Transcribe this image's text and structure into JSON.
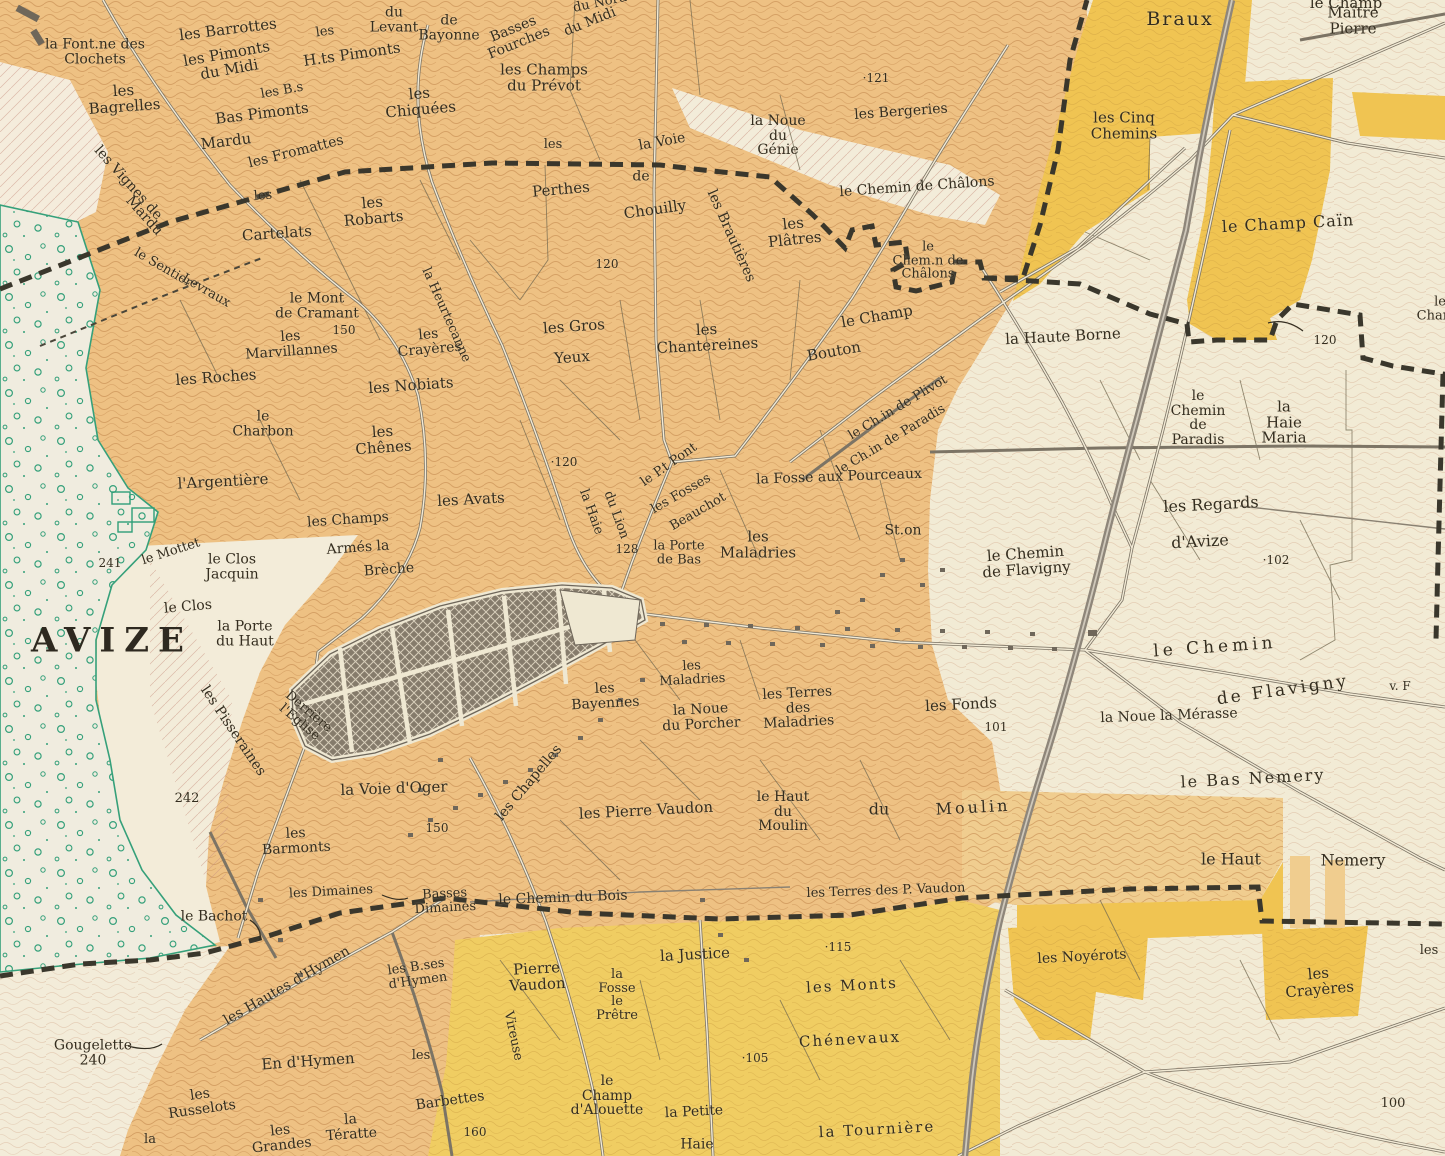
{
  "map": {
    "town_name": "AVIZE",
    "kind": "vineyard-cadastral-map",
    "colors": {
      "paper_cream": "#f2ebd5",
      "vineyard_orange": "#eec183",
      "pale_orange_band": "#f0cd8f",
      "plot_yellow": "#f0c452",
      "bottom_yellow": "#f0cd62",
      "woods_green": "#35a07a",
      "town_block_gray": "#857b6b",
      "railway_gray": "#8e867a",
      "boundary_ink": "#3a372c",
      "label_ink": "#342d1f"
    },
    "spot_heights": [
      "241",
      "242",
      "240",
      "150",
      "150",
      "160",
      "120",
      "120",
      "120",
      "121",
      "128",
      "115",
      "105",
      "102",
      "101",
      "100"
    ]
  },
  "labels": [
    {
      "t": "la Font.ne des\nClochets",
      "x": 95,
      "y": 52,
      "r": 0,
      "s": 14
    },
    {
      "t": "les Barrottes",
      "x": 228,
      "y": 30,
      "r": -7,
      "s": 15
    },
    {
      "t": "les Pimonts\ndu Midi",
      "x": 228,
      "y": 62,
      "r": -10,
      "s": 15
    },
    {
      "t": "les",
      "x": 325,
      "y": 32,
      "r": -8,
      "s": 13
    },
    {
      "t": "H.ts Pimonts",
      "x": 352,
      "y": 55,
      "r": -8,
      "s": 15
    },
    {
      "t": "du\nLevant",
      "x": 394,
      "y": 20,
      "r": 0,
      "s": 14
    },
    {
      "t": "de\nBayonne",
      "x": 449,
      "y": 28,
      "r": 0,
      "s": 14
    },
    {
      "t": "Basses\nFourches",
      "x": 516,
      "y": 36,
      "r": -22,
      "s": 14
    },
    {
      "t": "du Midi",
      "x": 590,
      "y": 22,
      "r": -22,
      "s": 14
    },
    {
      "t": "du Nord",
      "x": 600,
      "y": 3,
      "r": -12,
      "s": 13
    },
    {
      "t": "les\nBagrelles",
      "x": 124,
      "y": 99,
      "r": -4,
      "s": 15
    },
    {
      "t": "les B.s",
      "x": 282,
      "y": 91,
      "r": -10,
      "s": 13
    },
    {
      "t": "Bas Pimonts",
      "x": 262,
      "y": 114,
      "r": -7,
      "s": 15
    },
    {
      "t": "Mardu",
      "x": 226,
      "y": 142,
      "r": -7,
      "s": 15
    },
    {
      "t": "les Fromattes",
      "x": 296,
      "y": 152,
      "r": -14,
      "s": 14
    },
    {
      "t": "les\nChiquées",
      "x": 420,
      "y": 102,
      "r": -5,
      "s": 15
    },
    {
      "t": "les Vignes de",
      "x": 128,
      "y": 183,
      "r": 48,
      "s": 14
    },
    {
      "t": "Mardu",
      "x": 144,
      "y": 216,
      "r": 48,
      "s": 14
    },
    {
      "t": "les",
      "x": 263,
      "y": 196,
      "r": -4,
      "s": 13
    },
    {
      "t": "Cartelats",
      "x": 277,
      "y": 234,
      "r": -4,
      "s": 15
    },
    {
      "t": "les\nRobarts",
      "x": 373,
      "y": 211,
      "r": -5,
      "s": 15
    },
    {
      "t": "le Sentier",
      "x": 163,
      "y": 268,
      "r": 30,
      "s": 13
    },
    {
      "t": "Levraux",
      "x": 206,
      "y": 291,
      "r": 30,
      "s": 13
    },
    {
      "t": "les Champs\ndu Prévot",
      "x": 544,
      "y": 78,
      "r": 0,
      "s": 15
    },
    {
      "t": "la Voie",
      "x": 662,
      "y": 142,
      "r": -10,
      "s": 14
    },
    {
      "t": "de",
      "x": 641,
      "y": 177,
      "r": 0,
      "s": 14
    },
    {
      "t": "Chouilly",
      "x": 655,
      "y": 210,
      "r": -8,
      "s": 15
    },
    {
      "t": "les",
      "x": 553,
      "y": 145,
      "r": 0,
      "s": 13
    },
    {
      "t": "Perthes",
      "x": 561,
      "y": 190,
      "r": -5,
      "s": 15
    },
    {
      "t": "120",
      "x": 607,
      "y": 264,
      "r": 0,
      "s": 12
    },
    {
      "t": "la Noue\ndu\nGénie",
      "x": 778,
      "y": 136,
      "r": 0,
      "s": 14
    },
    {
      "t": "·121",
      "x": 876,
      "y": 78,
      "r": 0,
      "s": 12
    },
    {
      "t": "les Bergeries",
      "x": 901,
      "y": 112,
      "r": -4,
      "s": 14
    },
    {
      "t": "les Brautières",
      "x": 731,
      "y": 236,
      "r": 66,
      "s": 14
    },
    {
      "t": "les\nPlâtres",
      "x": 794,
      "y": 232,
      "r": -6,
      "s": 15
    },
    {
      "t": "le Chemin de Châlons",
      "x": 917,
      "y": 187,
      "r": -4,
      "s": 14
    },
    {
      "t": "le\nChem.n de\nChâlons",
      "x": 928,
      "y": 261,
      "r": 0,
      "s": 13
    },
    {
      "t": "le Champ",
      "x": 877,
      "y": 317,
      "r": -10,
      "s": 15
    },
    {
      "t": "Bouton",
      "x": 834,
      "y": 352,
      "r": -10,
      "s": 15
    },
    {
      "t": "la Haute Borne",
      "x": 1063,
      "y": 337,
      "r": -3,
      "s": 15
    },
    {
      "t": "les Cinq\nChemins",
      "x": 1124,
      "y": 126,
      "r": 0,
      "s": 15
    },
    {
      "t": "Braux",
      "x": 1180,
      "y": 20,
      "r": 0,
      "s": 19,
      "ls": 2
    },
    {
      "t": "le Champ",
      "x": 1346,
      "y": 4,
      "r": 0,
      "s": 15
    },
    {
      "t": "Maître Pierre",
      "x": 1353,
      "y": 21,
      "r": 0,
      "s": 15
    },
    {
      "t": "le Champ Caïn",
      "x": 1288,
      "y": 224,
      "r": -3,
      "s": 16,
      "ls": 1
    },
    {
      "t": "120",
      "x": 1325,
      "y": 340,
      "r": 0,
      "s": 12
    },
    {
      "t": "le Champ",
      "x": 1440,
      "y": 309,
      "r": 0,
      "s": 13
    },
    {
      "t": "le Ch.in de Plivot",
      "x": 898,
      "y": 408,
      "r": -31,
      "s": 13
    },
    {
      "t": "le Ch.in de Paradis",
      "x": 891,
      "y": 440,
      "r": -31,
      "s": 13
    },
    {
      "t": "la Heurtecanne",
      "x": 446,
      "y": 315,
      "r": 66,
      "s": 13
    },
    {
      "t": "le Mont\nde Cramant",
      "x": 317,
      "y": 306,
      "r": 0,
      "s": 14
    },
    {
      "t": "150",
      "x": 344,
      "y": 330,
      "r": 0,
      "s": 12
    },
    {
      "t": "les\nMarvillannes",
      "x": 291,
      "y": 344,
      "r": -4,
      "s": 14
    },
    {
      "t": "les\nCrayères",
      "x": 429,
      "y": 342,
      "r": -5,
      "s": 14
    },
    {
      "t": "les Roches",
      "x": 216,
      "y": 378,
      "r": -4,
      "s": 15
    },
    {
      "t": "les Nobiats",
      "x": 411,
      "y": 386,
      "r": -4,
      "s": 15
    },
    {
      "t": "le\nCharbon",
      "x": 263,
      "y": 424,
      "r": 0,
      "s": 14
    },
    {
      "t": "les\nChênes",
      "x": 383,
      "y": 440,
      "r": -4,
      "s": 15
    },
    {
      "t": "l'Argentière",
      "x": 223,
      "y": 482,
      "r": -3,
      "s": 15
    },
    {
      "t": "les Avats",
      "x": 471,
      "y": 500,
      "r": -3,
      "s": 15
    },
    {
      "t": "les Gros",
      "x": 574,
      "y": 327,
      "r": -4,
      "s": 15
    },
    {
      "t": "Yeux",
      "x": 572,
      "y": 358,
      "r": -4,
      "s": 15
    },
    {
      "t": "les\nChantereines",
      "x": 707,
      "y": 338,
      "r": -3,
      "s": 15
    },
    {
      "t": "·120",
      "x": 564,
      "y": 462,
      "r": 0,
      "s": 12
    },
    {
      "t": "la Haie",
      "x": 591,
      "y": 512,
      "r": 70,
      "s": 13
    },
    {
      "t": "du Lion",
      "x": 616,
      "y": 515,
      "r": 70,
      "s": 13
    },
    {
      "t": "le P.t Pont",
      "x": 669,
      "y": 465,
      "r": -35,
      "s": 13
    },
    {
      "t": "les Fosses",
      "x": 681,
      "y": 494,
      "r": -30,
      "s": 13
    },
    {
      "t": "Beauchot",
      "x": 698,
      "y": 512,
      "r": -30,
      "s": 13
    },
    {
      "t": "la Fosse aux Pourceaux",
      "x": 839,
      "y": 477,
      "r": -2,
      "s": 14
    },
    {
      "t": "128",
      "x": 627,
      "y": 549,
      "r": 0,
      "s": 12
    },
    {
      "t": "la Porte\nde Bas",
      "x": 679,
      "y": 553,
      "r": 0,
      "s": 13
    },
    {
      "t": "les\nMaladries",
      "x": 758,
      "y": 545,
      "r": 0,
      "s": 15
    },
    {
      "t": "St.on",
      "x": 903,
      "y": 531,
      "r": 0,
      "s": 14
    },
    {
      "t": "le Chemin\nde Flavigny",
      "x": 1026,
      "y": 562,
      "r": -4,
      "s": 15
    },
    {
      "t": "les Regards",
      "x": 1211,
      "y": 505,
      "r": -3,
      "s": 16
    },
    {
      "t": "d'Avize",
      "x": 1200,
      "y": 542,
      "r": -3,
      "s": 16
    },
    {
      "t": "·102",
      "x": 1276,
      "y": 560,
      "r": 0,
      "s": 12
    },
    {
      "t": "le\nChemin\nde\nParadis",
      "x": 1198,
      "y": 418,
      "r": 0,
      "s": 14
    },
    {
      "t": "la\nHaie\nMaria",
      "x": 1284,
      "y": 423,
      "r": 0,
      "s": 15
    },
    {
      "t": "les Champs",
      "x": 348,
      "y": 520,
      "r": -4,
      "s": 14
    },
    {
      "t": "Armés la",
      "x": 358,
      "y": 548,
      "r": -4,
      "s": 14
    },
    {
      "t": "Brèche",
      "x": 389,
      "y": 570,
      "r": -4,
      "s": 14
    },
    {
      "t": "le Clos\nJacquin",
      "x": 232,
      "y": 567,
      "r": 0,
      "s": 14
    },
    {
      "t": "241",
      "x": 110,
      "y": 563,
      "r": 0,
      "s": 12
    },
    {
      "t": "le Mottet",
      "x": 171,
      "y": 552,
      "r": -18,
      "s": 13
    },
    {
      "t": "le Clos",
      "x": 188,
      "y": 607,
      "r": -5,
      "s": 14
    },
    {
      "t": "la Porte\ndu Haut",
      "x": 245,
      "y": 634,
      "r": 0,
      "s": 14
    },
    {
      "t": "AVIZE",
      "x": 112,
      "y": 641,
      "r": 0,
      "s": 34,
      "b": true,
      "ls": 9
    },
    {
      "t": "Derrière\nl'Eglise",
      "x": 304,
      "y": 717,
      "r": 40,
      "s": 13
    },
    {
      "t": "les Pisseraines",
      "x": 233,
      "y": 731,
      "r": 56,
      "s": 14
    },
    {
      "t": "242",
      "x": 187,
      "y": 799,
      "r": 0,
      "s": 13
    },
    {
      "t": "la Voie d'Oger",
      "x": 394,
      "y": 789,
      "r": -2,
      "s": 15
    },
    {
      "t": "150",
      "x": 437,
      "y": 828,
      "r": 0,
      "s": 12
    },
    {
      "t": "les\nBarmonts",
      "x": 296,
      "y": 841,
      "r": -3,
      "s": 14
    },
    {
      "t": "les Chapelles",
      "x": 529,
      "y": 783,
      "r": -50,
      "s": 14
    },
    {
      "t": "les\nBayennes",
      "x": 605,
      "y": 696,
      "r": -3,
      "s": 14
    },
    {
      "t": "les\nMaladries",
      "x": 692,
      "y": 673,
      "r": -3,
      "s": 13
    },
    {
      "t": "la Noue\ndu Porcher",
      "x": 701,
      "y": 717,
      "r": -3,
      "s": 14
    },
    {
      "t": "les Terres\ndes\nMaladries",
      "x": 798,
      "y": 708,
      "r": -3,
      "s": 14
    },
    {
      "t": "les Pierre Vaudon",
      "x": 646,
      "y": 811,
      "r": -3,
      "s": 15
    },
    {
      "t": "le Haut\ndu\nMoulin",
      "x": 783,
      "y": 812,
      "r": 0,
      "s": 14
    },
    {
      "t": "les Fonds",
      "x": 961,
      "y": 705,
      "r": -3,
      "s": 15
    },
    {
      "t": "101",
      "x": 996,
      "y": 727,
      "r": 0,
      "s": 12
    },
    {
      "t": "du",
      "x": 879,
      "y": 810,
      "r": 0,
      "s": 16
    },
    {
      "t": "Moulin",
      "x": 973,
      "y": 808,
      "r": -3,
      "s": 16,
      "ls": 3
    },
    {
      "t": "le Chemin du Bois",
      "x": 563,
      "y": 898,
      "r": -2,
      "s": 14
    },
    {
      "t": "les Terres des P. Vaudon",
      "x": 886,
      "y": 891,
      "r": -2,
      "s": 13
    },
    {
      "t": "la Noue la Mérasse",
      "x": 1169,
      "y": 716,
      "r": -2,
      "s": 14
    },
    {
      "t": "le Bas Nemery",
      "x": 1253,
      "y": 779,
      "r": -3,
      "s": 16,
      "ls": 2
    },
    {
      "t": "le Haut",
      "x": 1231,
      "y": 860,
      "r": 0,
      "s": 16
    },
    {
      "t": "Nemery",
      "x": 1353,
      "y": 861,
      "r": 0,
      "s": 16
    },
    {
      "t": "le Chemin",
      "x": 1215,
      "y": 648,
      "r": -4,
      "s": 17,
      "ls": 4
    },
    {
      "t": "de Flavigny",
      "x": 1283,
      "y": 691,
      "r": -8,
      "s": 17,
      "ls": 3
    },
    {
      "t": "v. F",
      "x": 1400,
      "y": 686,
      "r": 0,
      "s": 12
    },
    {
      "t": "les Dimaines",
      "x": 331,
      "y": 892,
      "r": -3,
      "s": 13
    },
    {
      "t": "le Bachot",
      "x": 214,
      "y": 917,
      "r": 0,
      "s": 14
    },
    {
      "t": "Basses\nDimaines",
      "x": 445,
      "y": 901,
      "r": -3,
      "s": 13
    },
    {
      "t": "les Hautes d'Hymen",
      "x": 287,
      "y": 986,
      "r": -30,
      "s": 14
    },
    {
      "t": "les B.ses\nd'Hymen",
      "x": 417,
      "y": 974,
      "r": -8,
      "s": 13
    },
    {
      "t": "Gougelette\n240",
      "x": 93,
      "y": 1053,
      "r": 0,
      "s": 14
    },
    {
      "t": "En d'Hymen",
      "x": 308,
      "y": 1062,
      "r": -4,
      "s": 15
    },
    {
      "t": "les\nRusselots",
      "x": 201,
      "y": 1102,
      "r": -8,
      "s": 14
    },
    {
      "t": "la",
      "x": 150,
      "y": 1140,
      "r": 0,
      "s": 13
    },
    {
      "t": "les\nGrandes",
      "x": 281,
      "y": 1138,
      "r": -6,
      "s": 14
    },
    {
      "t": "la\nTératte",
      "x": 351,
      "y": 1127,
      "r": -4,
      "s": 14
    },
    {
      "t": "les",
      "x": 421,
      "y": 1056,
      "r": 0,
      "s": 13
    },
    {
      "t": "Barbettes",
      "x": 450,
      "y": 1101,
      "r": -8,
      "s": 14
    },
    {
      "t": "160",
      "x": 475,
      "y": 1132,
      "r": 0,
      "s": 12
    },
    {
      "t": "Vireuse",
      "x": 513,
      "y": 1036,
      "r": 78,
      "s": 13
    },
    {
      "t": "Pierre\nVaudon",
      "x": 537,
      "y": 977,
      "r": -3,
      "s": 15
    },
    {
      "t": "la\nFosse\nle\nPrêtre",
      "x": 617,
      "y": 995,
      "r": 0,
      "s": 13
    },
    {
      "t": "la Justice",
      "x": 695,
      "y": 955,
      "r": -3,
      "s": 15
    },
    {
      "t": "·115",
      "x": 838,
      "y": 947,
      "r": 0,
      "s": 12
    },
    {
      "t": "les Monts",
      "x": 852,
      "y": 986,
      "r": -3,
      "s": 15,
      "ls": 2
    },
    {
      "t": "Chénevaux",
      "x": 850,
      "y": 1040,
      "r": -3,
      "s": 15,
      "ls": 2
    },
    {
      "t": "·105",
      "x": 755,
      "y": 1058,
      "r": 0,
      "s": 12
    },
    {
      "t": "le\nChamp\nd'Alouette",
      "x": 607,
      "y": 1096,
      "r": 0,
      "s": 14
    },
    {
      "t": "la Petite",
      "x": 694,
      "y": 1112,
      "r": -3,
      "s": 14
    },
    {
      "t": "Haie",
      "x": 697,
      "y": 1145,
      "r": 0,
      "s": 14
    },
    {
      "t": "la Tournière",
      "x": 877,
      "y": 1130,
      "r": -3,
      "s": 15,
      "ls": 2
    },
    {
      "t": "les Noyérots",
      "x": 1082,
      "y": 957,
      "r": -3,
      "s": 14
    },
    {
      "t": "les\nCrayères",
      "x": 1319,
      "y": 982,
      "r": -5,
      "s": 15
    },
    {
      "t": "100",
      "x": 1393,
      "y": 1104,
      "r": 0,
      "s": 13
    },
    {
      "t": "les",
      "x": 1429,
      "y": 951,
      "r": 0,
      "s": 13
    }
  ]
}
